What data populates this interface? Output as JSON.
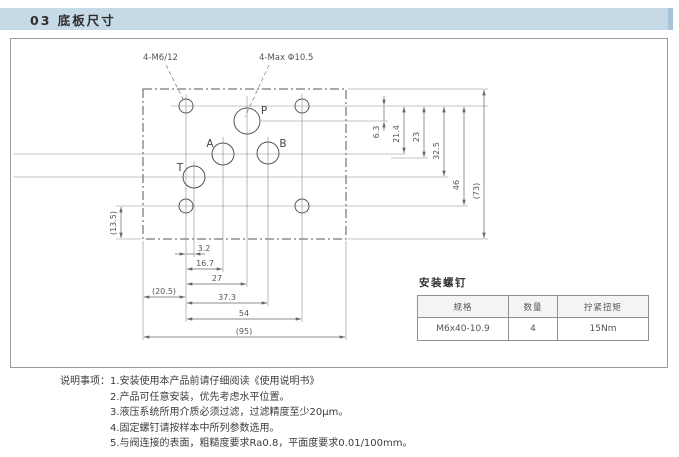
{
  "header": {
    "section_title": "03 底板尺寸"
  },
  "drawing": {
    "callouts": {
      "mounting_holes": "4-M6/12",
      "max_ports": "4-Max Φ10.5"
    },
    "ports": {
      "p": "P",
      "a": "A",
      "b": "B",
      "t": "T"
    },
    "dims": {
      "right": [
        "6.3",
        "21.4",
        "23",
        "32.5",
        "46",
        "(73)"
      ],
      "bottom": [
        "3.2",
        "16.7",
        "27",
        "(20.5)",
        "37.3",
        "54",
        "(95)"
      ],
      "left": "(13.5)"
    }
  },
  "screw_table": {
    "title": "安装螺钉",
    "headers": [
      "规格",
      "数量",
      "拧紧扭矩"
    ],
    "rows": [
      [
        "M6x40-10.9",
        "4",
        "15Nm"
      ]
    ]
  },
  "notes": {
    "label": "说明事项：",
    "items": [
      "1.安装使用本产品前请仔细阅读《使用说明书》",
      "2.产品可任意安装，优先考虑水平位置。",
      "3.液压系统所用介质必须过滤，过滤精度至少20μm。",
      "4.固定螺钉请按样本中所列参数选用。",
      "5.与阀连接的表面，粗糙度要求Ra0.8，平面度要求0.01/100mm。"
    ]
  }
}
